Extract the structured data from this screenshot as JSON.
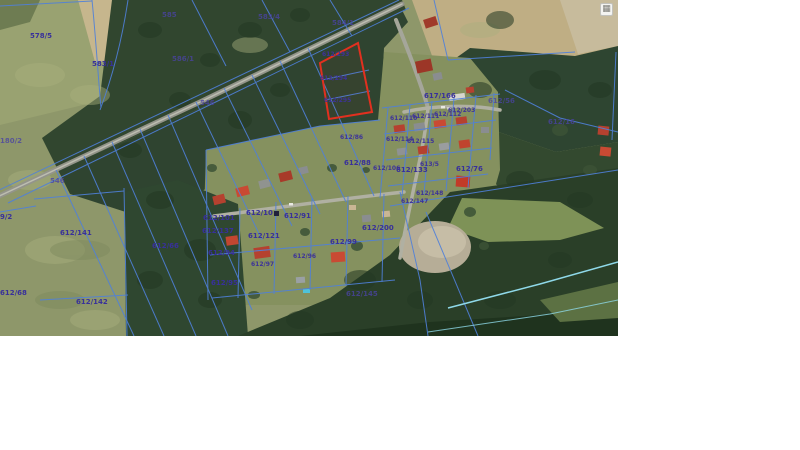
{
  "map": {
    "type": "cadastral-aerial-map",
    "selected_parcels": [
      "612/293",
      "612/294",
      "612/295"
    ],
    "colors": {
      "cadastral_line": "#4f80da",
      "selected_parcel_outline": "#e2301f",
      "parcel_label": "#38309b",
      "stream": "#8fd9e9",
      "page_background": "#ffffff"
    },
    "labels": [
      {
        "text": "578/5",
        "x": 30,
        "y": 33,
        "cls": ""
      },
      {
        "text": "583/1",
        "x": 92,
        "y": 61,
        "cls": ""
      },
      {
        "text": "585",
        "x": 162,
        "y": 12,
        "cls": "faint"
      },
      {
        "text": "586/1",
        "x": 172,
        "y": 56,
        "cls": "faint"
      },
      {
        "text": "583/4",
        "x": 258,
        "y": 14,
        "cls": "faint"
      },
      {
        "text": "584/1",
        "x": 332,
        "y": 20,
        "cls": "faint"
      },
      {
        "text": "546",
        "x": 200,
        "y": 100,
        "cls": "faint"
      },
      {
        "text": "180/2",
        "x": 0,
        "y": 138,
        "cls": "faint"
      },
      {
        "text": "546",
        "x": 50,
        "y": 178,
        "cls": "faint"
      },
      {
        "text": "9/2",
        "x": 0,
        "y": 214,
        "cls": ""
      },
      {
        "text": "612/141",
        "x": 60,
        "y": 230,
        "cls": ""
      },
      {
        "text": "612/66",
        "x": 152,
        "y": 243,
        "cls": ""
      },
      {
        "text": "612/68",
        "x": 0,
        "y": 290,
        "cls": ""
      },
      {
        "text": "612/142",
        "x": 76,
        "y": 299,
        "cls": ""
      },
      {
        "text": "612/293",
        "x": 322,
        "y": 52,
        "cls": "small"
      },
      {
        "text": "612/294",
        "x": 320,
        "y": 76,
        "cls": "small"
      },
      {
        "text": "612/295",
        "x": 324,
        "y": 98,
        "cls": "small"
      },
      {
        "text": "617/166",
        "x": 424,
        "y": 93,
        "cls": ""
      },
      {
        "text": "612/56",
        "x": 488,
        "y": 98,
        "cls": "faint"
      },
      {
        "text": "612/16",
        "x": 548,
        "y": 119,
        "cls": "faint"
      },
      {
        "text": "612/203",
        "x": 448,
        "y": 108,
        "cls": "small"
      },
      {
        "text": "612/110",
        "x": 390,
        "y": 116,
        "cls": "small"
      },
      {
        "text": "612/111",
        "x": 412,
        "y": 114,
        "cls": "small"
      },
      {
        "text": "612/112",
        "x": 434,
        "y": 112,
        "cls": "small"
      },
      {
        "text": "612/86",
        "x": 340,
        "y": 135,
        "cls": "small"
      },
      {
        "text": "612/114",
        "x": 386,
        "y": 137,
        "cls": "small"
      },
      {
        "text": "612/115",
        "x": 407,
        "y": 139,
        "cls": "small"
      },
      {
        "text": "612/88",
        "x": 344,
        "y": 160,
        "cls": ""
      },
      {
        "text": "612/106",
        "x": 373,
        "y": 166,
        "cls": "small"
      },
      {
        "text": "612/133",
        "x": 396,
        "y": 167,
        "cls": ""
      },
      {
        "text": "613/5",
        "x": 420,
        "y": 162,
        "cls": "small"
      },
      {
        "text": "612/76",
        "x": 456,
        "y": 166,
        "cls": ""
      },
      {
        "text": "612/148",
        "x": 416,
        "y": 191,
        "cls": "small"
      },
      {
        "text": "612/147",
        "x": 401,
        "y": 199,
        "cls": "small"
      },
      {
        "text": "612/10",
        "x": 246,
        "y": 210,
        "cls": "boxed"
      },
      {
        "text": "612/91",
        "x": 284,
        "y": 213,
        "cls": ""
      },
      {
        "text": "612/101",
        "x": 203,
        "y": 215,
        "cls": ""
      },
      {
        "text": "612/137",
        "x": 202,
        "y": 228,
        "cls": ""
      },
      {
        "text": "612/121",
        "x": 248,
        "y": 233,
        "cls": ""
      },
      {
        "text": "612/200",
        "x": 362,
        "y": 225,
        "cls": ""
      },
      {
        "text": "612/99",
        "x": 330,
        "y": 239,
        "cls": ""
      },
      {
        "text": "612/94",
        "x": 208,
        "y": 250,
        "cls": ""
      },
      {
        "text": "612/97",
        "x": 251,
        "y": 262,
        "cls": "small"
      },
      {
        "text": "612/96",
        "x": 293,
        "y": 254,
        "cls": "small"
      },
      {
        "text": "612/95",
        "x": 211,
        "y": 280,
        "cls": ""
      },
      {
        "text": "612/145",
        "x": 346,
        "y": 291,
        "cls": "faint"
      }
    ]
  },
  "widget": {
    "icon": "grid-icon",
    "glyph": "▦"
  }
}
